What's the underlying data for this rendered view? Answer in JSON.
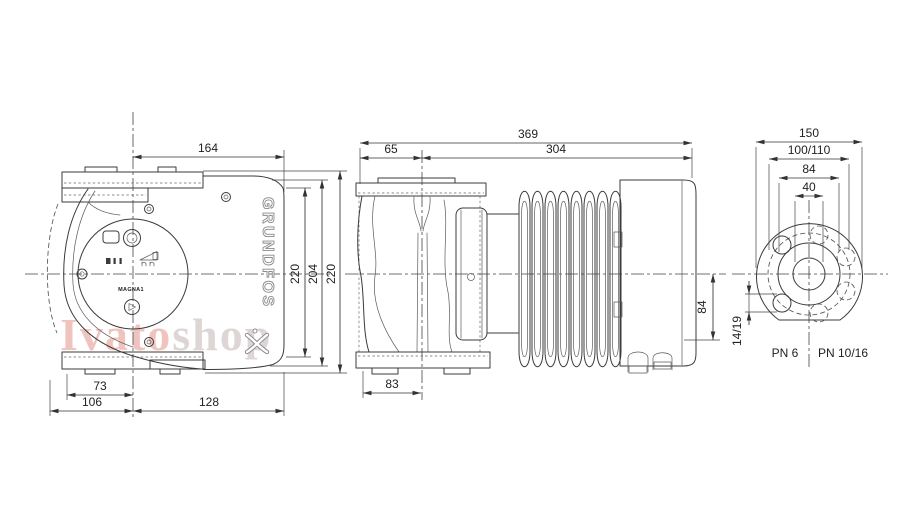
{
  "watermark": {
    "part1": "Ivato",
    "part2": "shop"
  },
  "front_view": {
    "logo_text": "GRUNDFOS",
    "model_label": "MAGNA1",
    "dims": {
      "top_width": "164",
      "height_inner": "220",
      "height_mid": "204",
      "height_outer": "220",
      "base_left": "73",
      "base_left_total": "106",
      "base_right": "128"
    }
  },
  "side_view": {
    "dims": {
      "total_length": "369",
      "face_to_axis": "65",
      "axis_to_end": "304",
      "axis_to_bottom": "84",
      "foot_width": "83"
    }
  },
  "flange_view": {
    "dims": {
      "outer_diameter": "150",
      "bolt_circle": "100/110",
      "raised_face": "84",
      "bore": "40",
      "bolt_holes": "14/19"
    },
    "labels": {
      "pn6": "PN 6",
      "pn1016": "PN 10/16"
    }
  }
}
